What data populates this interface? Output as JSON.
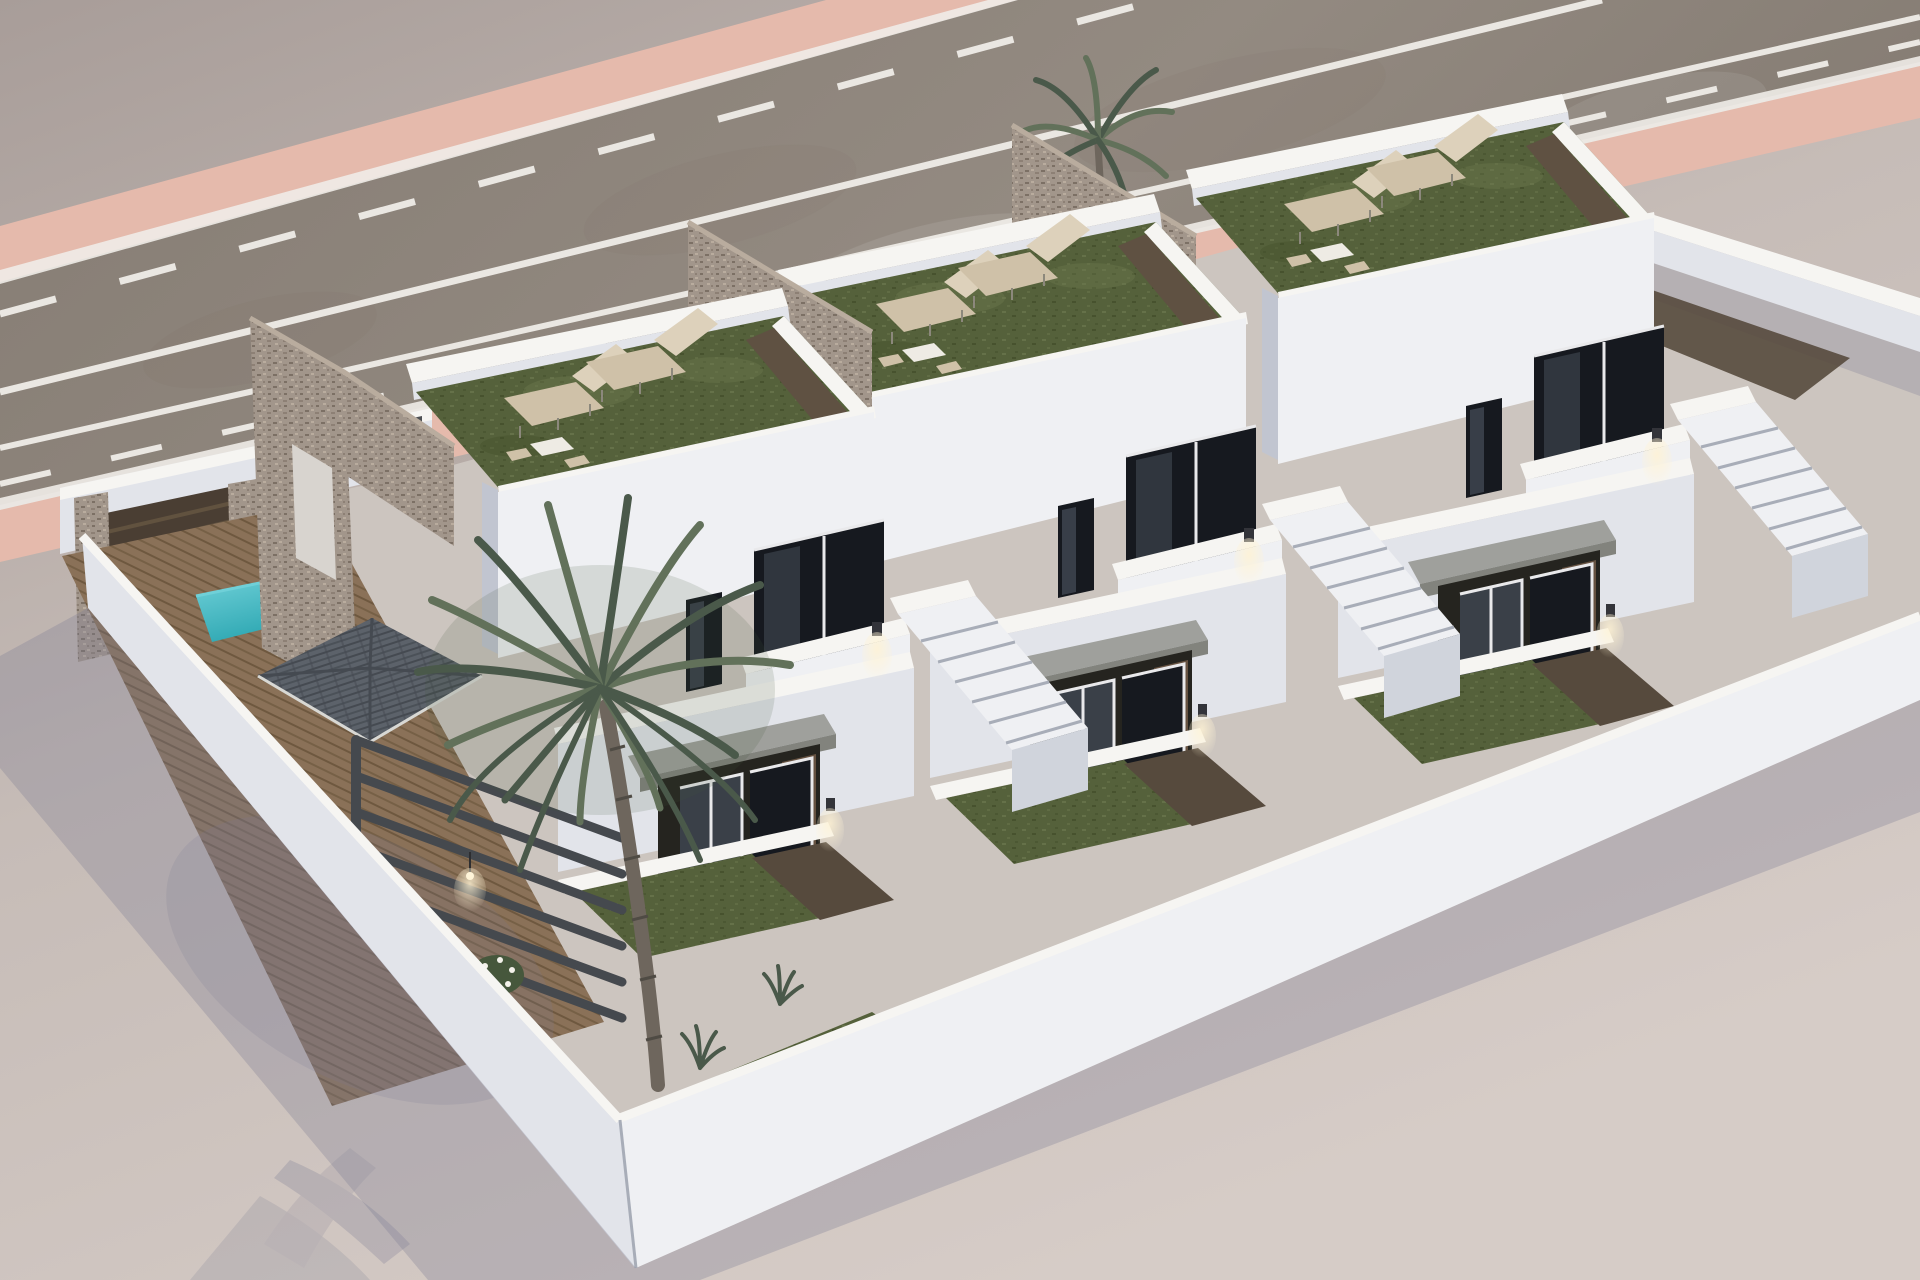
{
  "meta": {
    "type": "3d-architectural-render",
    "subject": "Aerial 3D render of three modern white two-storey townhouses with rooftop grass terraces, sun loungers, stone feature walls, a private pool with wood deck, palm trees and a road with pink sidewalks",
    "visible_text": "none"
  },
  "scene": {
    "environment": {
      "road": {
        "surface": "asphalt",
        "markings": [
          "dashed white line",
          "solid white line",
          "solid white line",
          "dashed white line"
        ],
        "sidewalks": "pink strips on both edges",
        "orientation": "diagonal band across the top, receding to the upper right"
      },
      "ground": "light warm grey plot with long blue-grey wall shadows cast to the lower left",
      "lighting": "bright daylight, wall sconces switched on"
    },
    "compound": {
      "perimeter": "white rendered walls on left, front and right boundaries",
      "entrance": "dark brown slatted gate between stone pillars at the rear left",
      "parked_car": "white car on the street behind house 1"
    },
    "houses": [
      {
        "id": 1,
        "position": "front-left",
        "features": [
          "rooftop terrace with artificial grass",
          "2 sun loungers",
          "roof table with 2 chairs",
          "tall stone feature wall with opening",
          "private pool",
          "timber deck",
          "large palm tree",
          "grey pergola beams with pendant light",
          "slate tiled porch canopy",
          "dark glazed windows",
          "wall sconces"
        ]
      },
      {
        "id": 2,
        "position": "middle",
        "features": [
          "rooftop terrace with artificial grass",
          "2 sun loungers",
          "roof table with 2 chairs",
          "stone feature wall",
          "dark glass balcony corner",
          "porch with grey canopy and glass doors",
          "external staircase",
          "front yard with grass and dark path",
          "wall sconces"
        ]
      },
      {
        "id": 3,
        "position": "back-right",
        "features": [
          "rooftop terrace with artificial grass",
          "2 sun loungers",
          "roof table with 2 chairs",
          "stone feature wall",
          "small palm behind wall",
          "dark glass balcony corner",
          "external staircase",
          "dark side passage",
          "wall sconces"
        ]
      }
    ],
    "counts": {
      "houses": 3,
      "stone_feature_walls": 3,
      "palm_trees": 2,
      "sun_loungers_per_roof": 2,
      "pools": 1,
      "gates": 1,
      "cars": 1
    }
  },
  "palette": {
    "bg_top": "#a89d99",
    "bg_mid": "#c6bcb7",
    "bg_bottom": "#d6ccc7",
    "road": "#857c73",
    "road_light": "#938a81",
    "road_dark": "#6e675f",
    "lane_mark": "#eae7e2",
    "sidewalk_pink": "#e5baac",
    "curb": "#efece8",
    "wall_top": "#f6f5f2",
    "wall_bright": "#eff0f3",
    "wall_light": "#e2e4ea",
    "wall_mid": "#d0d4dc",
    "wall_dark": "#c1c5d0",
    "stone_base": "#a2968b",
    "stone_mid": "#8d8075",
    "stone_dark": "#7c7065",
    "stone_light": "#b9ac9e",
    "turf": "#55613b",
    "turf_light": "#6c784e",
    "turf_dark": "#434f2b",
    "walkway_wood": "#5f5142",
    "deck": "#8a7158",
    "deck_line": "#6e583f",
    "pool": "#2fa8b3",
    "pool_light": "#6fd0d8",
    "glass_dark": "#16191f",
    "glass_mid": "#3c434c",
    "frame": "#e9e9eb",
    "canopy": "#9fa09c",
    "canopy_dark": "#82837d",
    "roof_tile": "#5c626a",
    "roof_tile_line": "#454a51",
    "fascia": "#d8d8d4",
    "pergola": "#45494e",
    "gate": "#4a3e33",
    "gate_line": "#61523f",
    "palm_leaf": "#62715a",
    "palm_leaf_dark": "#4a594a",
    "palm_trunk": "#6e665d",
    "lounger": "#cfc1a8",
    "lounger_light": "#ddd1bb",
    "metal_leg": "#8c887c",
    "shadow": "#797b93",
    "glow": "#fff3d4",
    "plant_green": "#46573c",
    "path_dark": "#564a3d",
    "interior_dark": "#25241f",
    "interior_wood": "#6e5845",
    "ground_inner": "#ccc5bf",
    "step_line": "#a8adb8",
    "car_white": "#f2f3f1",
    "table_white": "#eeebe4",
    "sconce_body": "#33343a"
  }
}
